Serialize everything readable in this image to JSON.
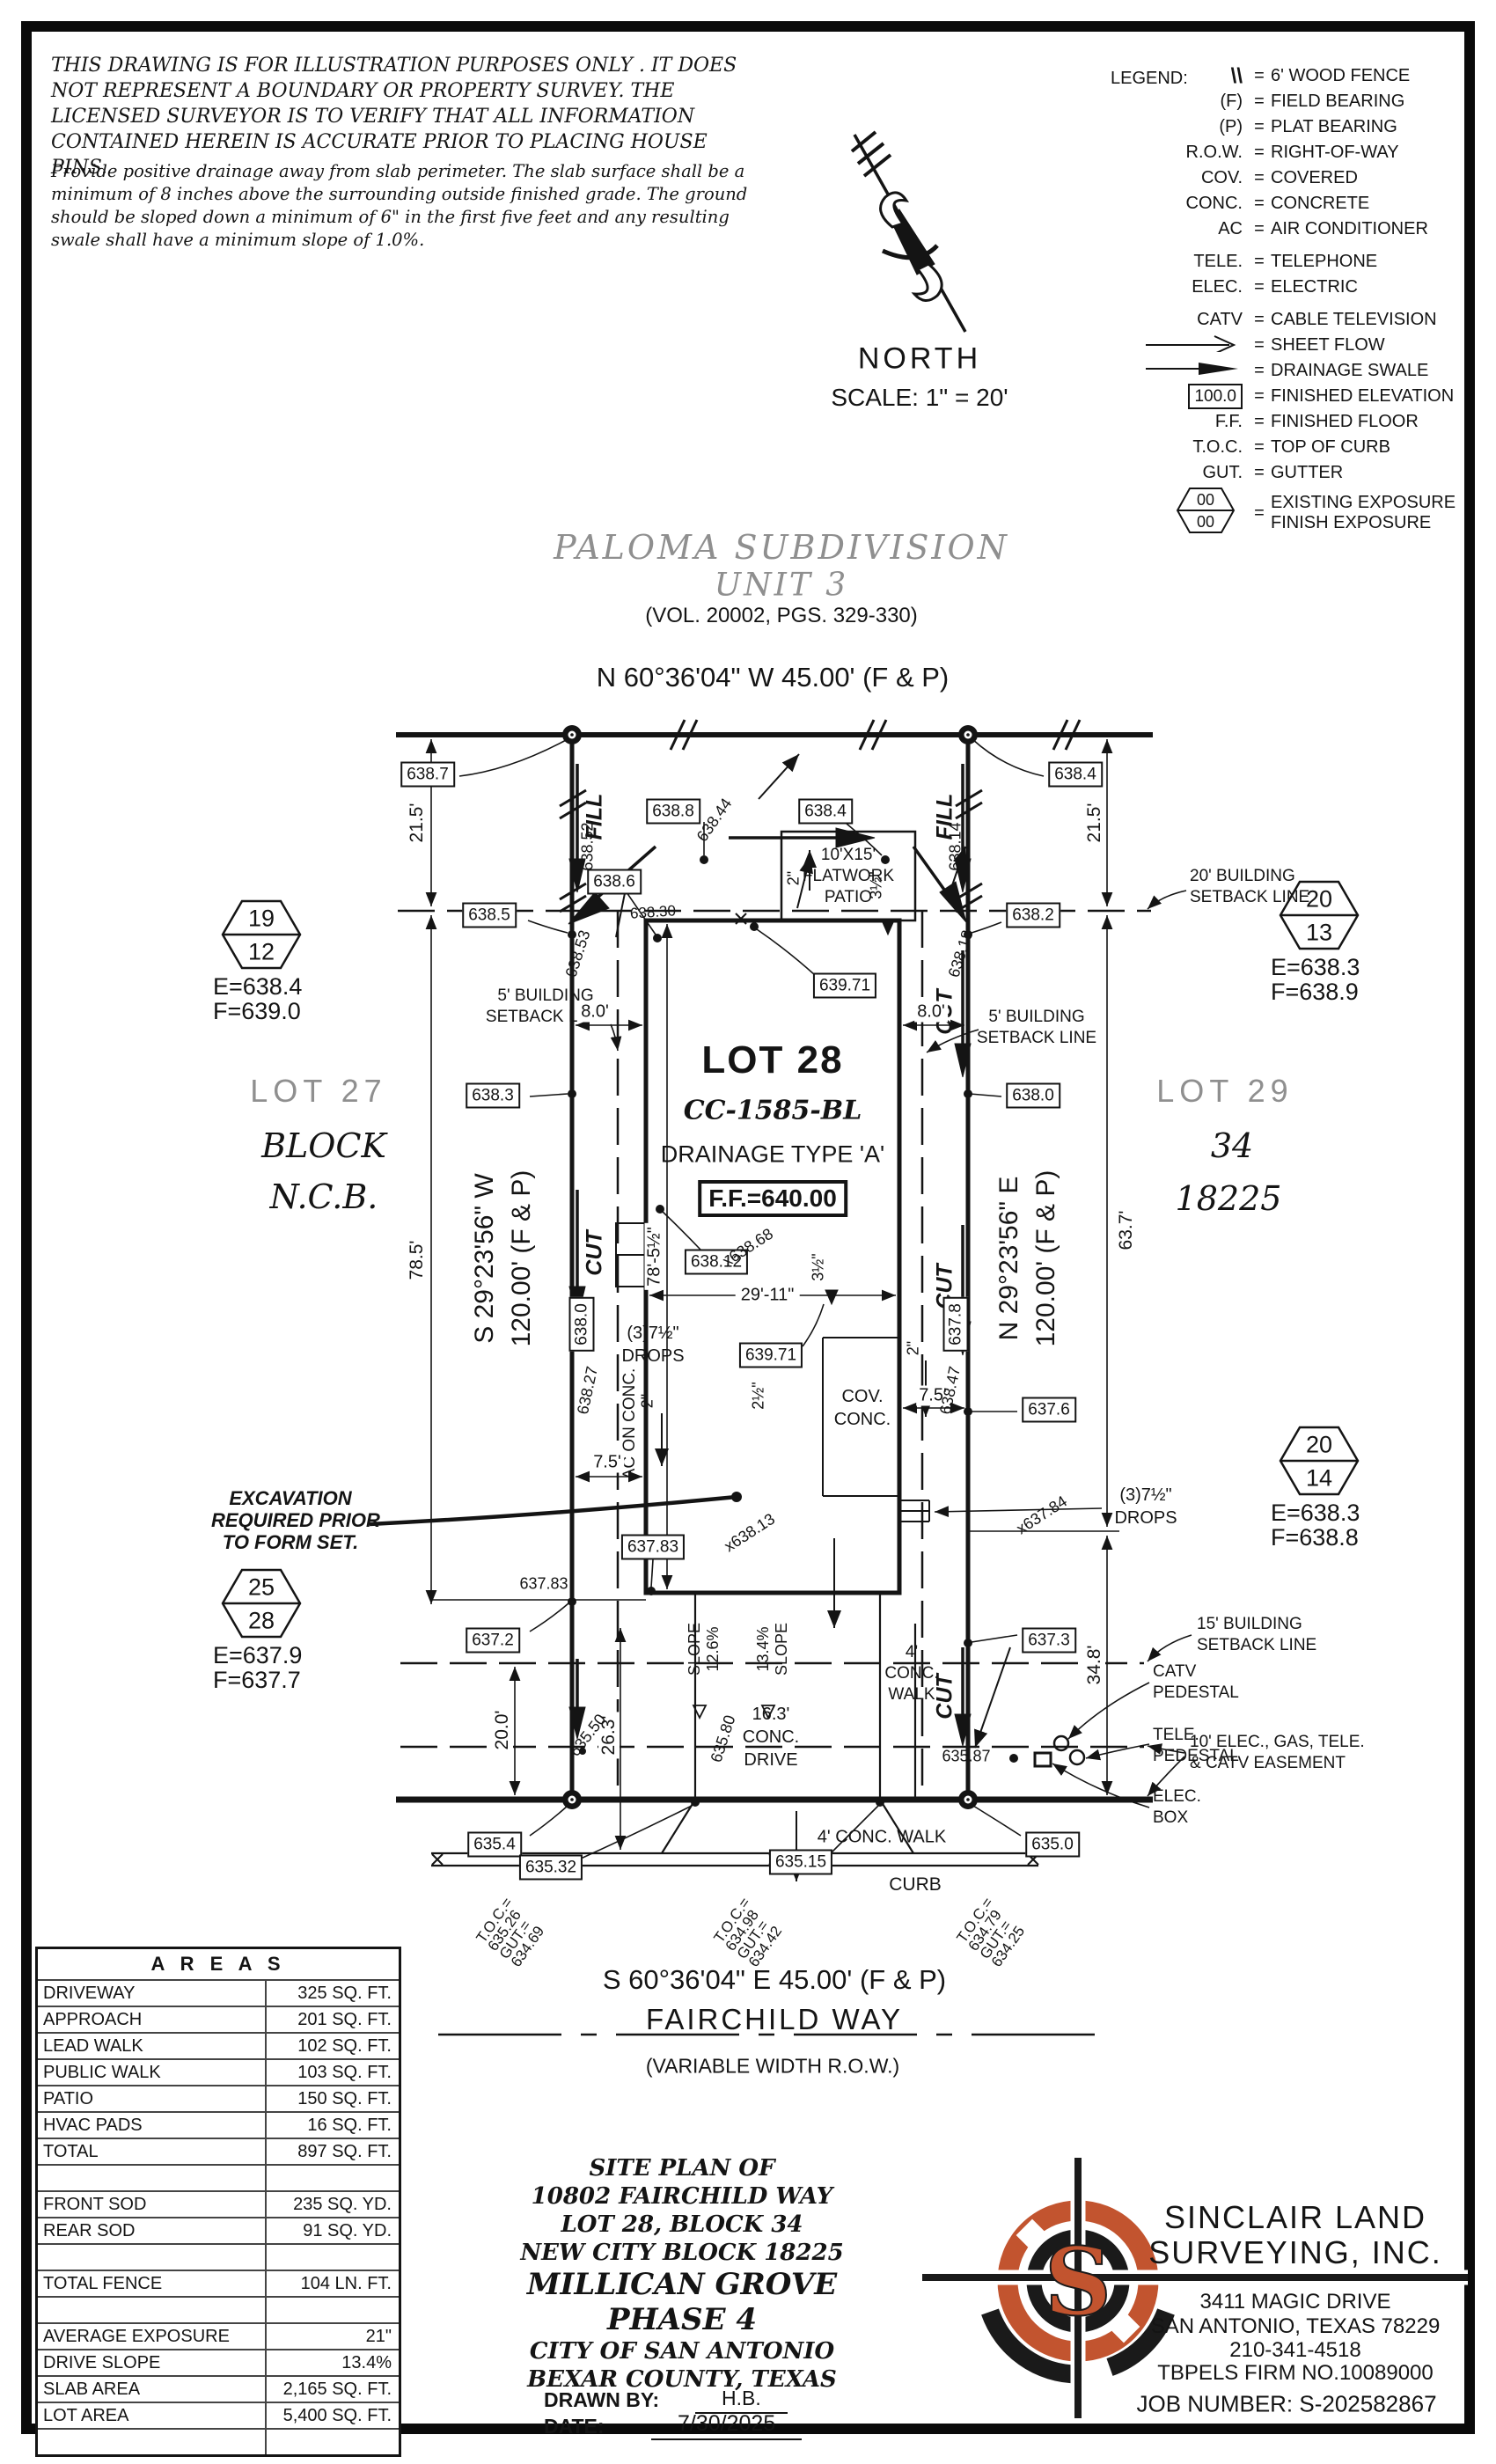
{
  "disclaimer": {
    "para1": "THIS DRAWING IS FOR ILLUSTRATION PURPOSES ONLY . IT DOES NOT REPRESENT A BOUNDARY OR PROPERTY SURVEY. THE LICENSED SURVEYOR IS TO VERIFY THAT ALL INFORMATION CONTAINED HEREIN IS ACCURATE PRIOR TO PLACING HOUSE PINS.",
    "para2": "Provide positive drainage away from slab perimeter. The slab surface shall be a minimum of 8 inches above the surrounding outside finished grade. The ground should be sloped down a minimum of 6\" in the first five feet and any resulting swale shall have a minimum slope of 1.0%."
  },
  "north": {
    "label": "NORTH",
    "scale": "SCALE: 1\" = 20'"
  },
  "legend": {
    "title": "LEGEND:",
    "hex_top": "00",
    "hex_bottom": "00",
    "rows": [
      {
        "sym": "\\\\",
        "desc": "6' WOOD FENCE"
      },
      {
        "sym": "(F)",
        "desc": "FIELD BEARING"
      },
      {
        "sym": "(P)",
        "desc": "PLAT BEARING"
      },
      {
        "sym": "R.O.W.",
        "desc": "RIGHT-OF-WAY"
      },
      {
        "sym": "COV.",
        "desc": "COVERED"
      },
      {
        "sym": "CONC.",
        "desc": "CONCRETE"
      },
      {
        "sym": "AC",
        "desc": "AIR CONDITIONER"
      },
      {
        "sym": "TELE.",
        "desc": "TELEPHONE"
      },
      {
        "sym": "ELEC.",
        "desc": "ELECTRIC"
      },
      {
        "sym": "CATV",
        "desc": "CABLE TELEVISION"
      },
      {
        "sym": "",
        "desc": "SHEET FLOW"
      },
      {
        "sym": "",
        "desc": "DRAINAGE SWALE"
      },
      {
        "sym": "100.0",
        "desc": "FINISHED ELEVATION"
      },
      {
        "sym": "F.F.",
        "desc": "FINISHED FLOOR"
      },
      {
        "sym": "T.O.C.",
        "desc": "TOP OF CURB"
      },
      {
        "sym": "GUT.",
        "desc": "GUTTER"
      },
      {
        "sym": "",
        "desc": "EXISTING EXPOSURE",
        "desc2": "FINISH EXPOSURE"
      }
    ]
  },
  "subdivision": {
    "line1": "PALOMA SUBDIVISION",
    "line2": "UNIT 3",
    "vol": "(VOL. 20002, PGS. 329-330)"
  },
  "bearings": {
    "north_line": "N 60°36'04\" W 45.00' (F & P)",
    "south_line": "S 60°36'04\" E 45.00' (F & P)",
    "west1": "S 29°23'56\" W",
    "west2": "120.00' (F & P)",
    "east1": "N 29°23'56\" E",
    "east2": "120.00' (F & P)"
  },
  "street": {
    "name": "FAIRCHILD WAY",
    "row": "(VARIABLE WIDTH R.O.W.)",
    "curb": "CURB",
    "walk": "4' CONC. WALK"
  },
  "adjacent": {
    "left": {
      "lot": "LOT 27",
      "block": "BLOCK",
      "ncb": "N.C.B."
    },
    "right": {
      "lot": "LOT 29",
      "block": "34",
      "ncb": "18225"
    }
  },
  "lot": {
    "name": "LOT 28",
    "cc": "CC-1585-BL",
    "drainage": "DRAINAGE TYPE 'A'",
    "ff": "F.F.=640.00"
  },
  "hex": [
    {
      "top": "19",
      "bottom": "12",
      "e": "E=638.4",
      "f": "F=639.0"
    },
    {
      "top": "20",
      "bottom": "13",
      "e": "E=638.3",
      "f": "F=638.9"
    },
    {
      "top": "20",
      "bottom": "14",
      "e": "E=638.3",
      "f": "F=638.8"
    },
    {
      "top": "25",
      "bottom": "28",
      "e": "E=637.9",
      "f": "F=637.7"
    }
  ],
  "setbacks": {
    "s20": "20' BUILDING SETBACK LINE",
    "s5a": "5' BUILDING",
    "s5b": "SETBACK LINE",
    "s15a": "15' BUILDING",
    "s15b": "SETBACK LINE",
    "ease1": "10' ELEC., GAS, TELE.",
    "ease2": "& CATV EASEMENT"
  },
  "excavation": {
    "l1": "EXCAVATION",
    "l2": "REQUIRED PRIOR",
    "l3": "TO FORM SET."
  },
  "patio": {
    "l1": "10'X15'",
    "l2": "FLATWORK",
    "l3": "PATIO"
  },
  "covconc": {
    "l1": "COV.",
    "l2": "CONC."
  },
  "drops": {
    "l1": "(3)7½\"",
    "l2": "DROPS"
  },
  "acon": "AC ON CONC.",
  "drive": {
    "l1": "16.3'",
    "l2": "CONC.",
    "l3": "DRIVE"
  },
  "walkcol": {
    "l1": "4'",
    "l2": "CONC.",
    "l3": "WALK"
  },
  "slopes": {
    "g1a": "SLOPE",
    "g1b": "12.6%",
    "g2a": "13.4%",
    "g2b": "SLOPE"
  },
  "cutfill": {
    "fill": "FILL",
    "cut": "CUT"
  },
  "dims": {
    "d21l": "21.5'",
    "d21r": "21.5'",
    "d785": "78.5'",
    "d637": "63.7'",
    "d348": "34.8'",
    "d200": "20.0'",
    "d263": "26.3'",
    "d78h": "78'-5½\"",
    "d2911": "29'-11\"",
    "d80l": "8.0'",
    "d80r": "8.0'",
    "d75l": "7.5'",
    "d75r": "7.5'",
    "d2a": "2\"",
    "d2b": "2\"",
    "d2c": "2\"",
    "d25": "2½\"",
    "d35a": "3½\"",
    "d35b": "3½\""
  },
  "elev": {
    "b6387": "638.7",
    "b6384a": "638.4",
    "b6388": "638.8",
    "b6384b": "638.4",
    "b6386": "638.6",
    "b6385": "638.5",
    "b6382": "638.2",
    "b63971a": "639.71",
    "b63971b": "639.71",
    "b6383": "638.3",
    "b6380r": "638.0",
    "b63812": "638.12",
    "b6380rot": "638.0",
    "b6378rot": "637.8",
    "b6376": "637.6",
    "b63783": "637.83",
    "b6372": "637.2",
    "b6373": "637.3",
    "b6354": "635.4",
    "b63532": "635.32",
    "b63515": "635.15",
    "b6350": "635.0",
    "t63852": "638.52",
    "t63844": "638.44",
    "t63814": "638.14",
    "t63853": "638.53",
    "t63818": "638.18",
    "t63830": "638.30",
    "t63827": "638.27",
    "t63847": "638.47",
    "t63868": "x638.68",
    "t63813": "x638.13",
    "t63784": "x637.84",
    "t63783": "637.83",
    "t63550": "635.50",
    "t63580": "635.80",
    "t63587": "635.87"
  },
  "utilities": {
    "catv1": "CATV",
    "catv2": "PEDESTAL",
    "tele1": "TELE.",
    "tele2": "PEDESTAL",
    "elec1": "ELEC.",
    "elec2": "BOX"
  },
  "toc": [
    {
      "a": "T.O.C.=",
      "b": "635.26",
      "c": "GUT.=",
      "d": "634.69"
    },
    {
      "a": "T.O.C.=",
      "b": "634.98",
      "c": "GUT.=",
      "d": "634.42"
    },
    {
      "a": "T.O.C.=",
      "b": "634.79",
      "c": "GUT.=",
      "d": "634.25"
    }
  ],
  "areas": {
    "title": "A R E A S",
    "rows": [
      [
        "DRIVEWAY",
        "325 SQ. FT."
      ],
      [
        "APPROACH",
        "201 SQ. FT."
      ],
      [
        "LEAD WALK",
        "102 SQ. FT."
      ],
      [
        "PUBLIC WALK",
        "103 SQ. FT."
      ],
      [
        "PATIO",
        "150 SQ. FT."
      ],
      [
        "HVAC PADS",
        "16 SQ. FT."
      ],
      [
        "TOTAL",
        "897 SQ. FT."
      ],
      [
        "",
        ""
      ],
      [
        "FRONT SOD",
        "235 SQ. YD."
      ],
      [
        "REAR SOD",
        "91 SQ. YD."
      ],
      [
        "",
        ""
      ],
      [
        "TOTAL FENCE",
        "104 LN. FT."
      ],
      [
        "",
        ""
      ],
      [
        "AVERAGE EXPOSURE",
        "21\""
      ],
      [
        "DRIVE SLOPE",
        "13.4%"
      ],
      [
        "SLAB AREA",
        "2,165 SQ. FT."
      ],
      [
        "LOT AREA",
        "5,400 SQ. FT."
      ],
      [
        "",
        ""
      ]
    ]
  },
  "titleblock": {
    "l1": "SITE PLAN OF",
    "l2": "10802 FAIRCHILD WAY",
    "l3": "LOT 28, BLOCK 34",
    "l4": "NEW CITY BLOCK 18225",
    "l5": "MILLICAN GROVE",
    "l6": "PHASE 4",
    "l7": "CITY OF SAN ANTONIO",
    "l8": "BEXAR COUNTY, TEXAS",
    "drawn_label": "DRAWN BY:",
    "drawn": "H.B.",
    "date_label": "DATE:",
    "date": "7/30/2025"
  },
  "surveyor": {
    "name1": "SINCLAIR LAND",
    "name2": "SURVEYING, INC.",
    "addr1": "3411 MAGIC DRIVE",
    "addr2": "SAN ANTONIO, TEXAS 78229",
    "phone": "210-341-4518",
    "firm": "TBPELS FIRM NO.10089000",
    "job": "JOB NUMBER: S-202582867",
    "logo_letter": "S"
  },
  "colors": {
    "accent": "#C2542F",
    "ink": "#141414",
    "gray": "#8f8f8f"
  }
}
